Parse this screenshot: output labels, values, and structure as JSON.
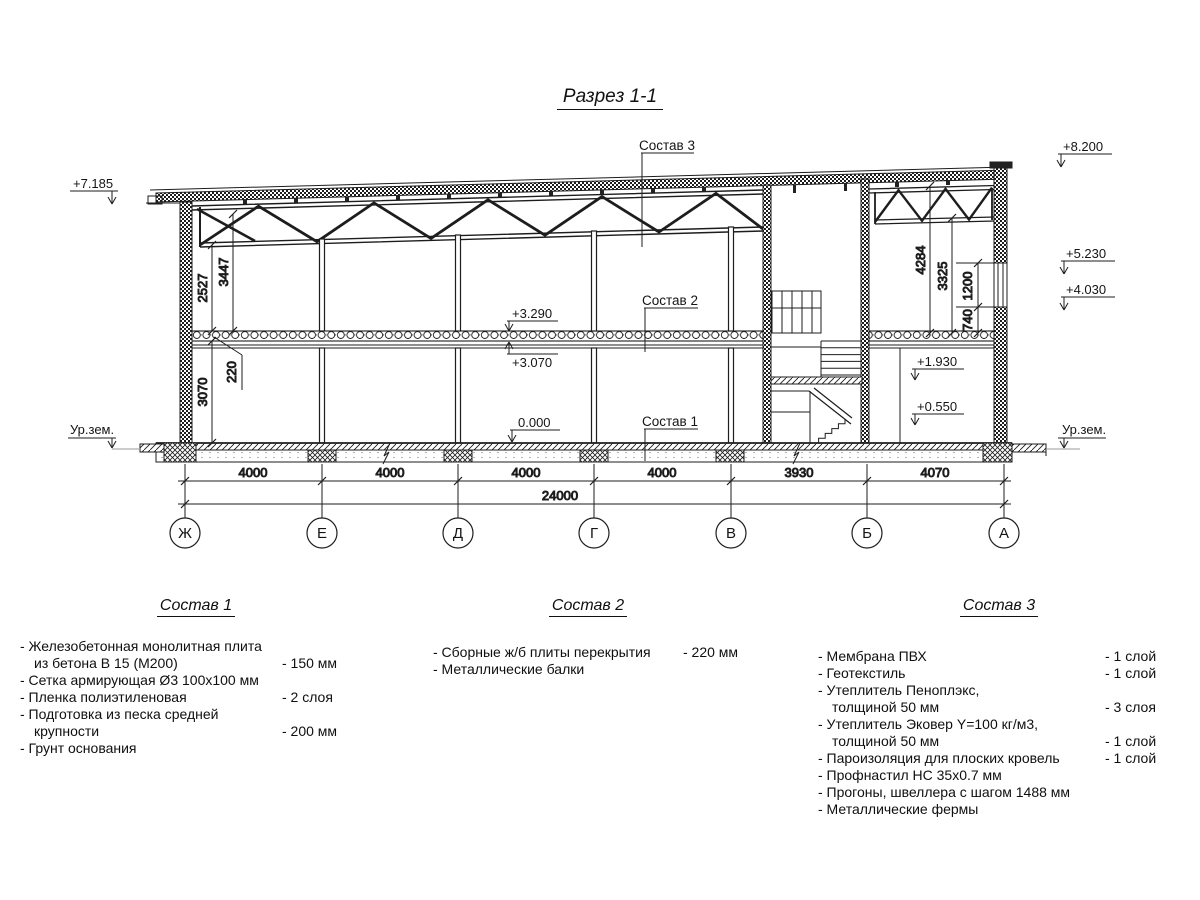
{
  "title": "Разрез 1-1",
  "colors": {
    "line": "#1d1d1d",
    "background": "#ffffff"
  },
  "drawing": {
    "marks": {
      "left_eave": "+7.185",
      "right_parapet": "+8.200",
      "right_window_top": "+5.230",
      "right_window_sill": "+4.030",
      "slab_top": "+3.290",
      "slab_bottom": "+3.070",
      "floor_zero": "0.000",
      "landing": "+1.930",
      "platform": "+0.550"
    },
    "ground_labels": {
      "left": "Ур.зем.",
      "right": "Ур.зем."
    },
    "callouts": {
      "c1": "Состав 1",
      "c2": "Состав 2",
      "c3": "Состав 3"
    },
    "dims_left": [
      "2527",
      "3447",
      "220",
      "3070"
    ],
    "dims_right": [
      "4284",
      "3325",
      "1200",
      "740"
    ],
    "dims_bottom": [
      "4000",
      "4000",
      "4000",
      "4000",
      "3930",
      "4070"
    ],
    "dim_total": "24000",
    "axes": [
      "Ж",
      "Е",
      "Д",
      "Г",
      "В",
      "Б",
      "А"
    ]
  },
  "legend": {
    "sections": [
      {
        "title": "Состав 1",
        "items": [
          {
            "text": "- Железобетонная  монолитная плита",
            "value": ""
          },
          {
            "text": "из бетона В 15 (М200)",
            "value": "- 150 мм"
          },
          {
            "text": "- Сетка армирующая Ø3 100x100 мм",
            "value": ""
          },
          {
            "text": "- Пленка полиэтиленовая",
            "value": "- 2 слоя"
          },
          {
            "text": "- Подготовка из песка средней",
            "value": ""
          },
          {
            "text": "крупности",
            "value": "- 200 мм"
          },
          {
            "text": "- Грунт основания",
            "value": ""
          }
        ]
      },
      {
        "title": "Состав 2",
        "items": [
          {
            "text": "- Сборные ж/б плиты перекрытия",
            "value": "- 220 мм"
          },
          {
            "text": "- Металлические балки",
            "value": ""
          }
        ]
      },
      {
        "title": "Состав 3",
        "items": [
          {
            "text": "- Мембрана ПВХ",
            "value": "- 1 слой"
          },
          {
            "text": "- Геотекстиль",
            "value": "- 1 слой"
          },
          {
            "text": "- Утеплитель Пеноплэкс,",
            "value": ""
          },
          {
            "text": "толщиной 50 мм",
            "value": "- 3 слоя"
          },
          {
            "text": "- Утеплитель Эковер Y=100 кг/м3,",
            "value": ""
          },
          {
            "text": "толщиной 50 мм",
            "value": "- 1 слой"
          },
          {
            "text": "- Пароизоляция для плоских кровель",
            "value": "- 1 слой"
          },
          {
            "text": "- Профнастил НС 35x0.7 мм",
            "value": ""
          },
          {
            "text": "- Прогоны, швеллера с шагом 1488 мм",
            "value": ""
          },
          {
            "text": "- Металлические фермы",
            "value": ""
          }
        ]
      }
    ]
  }
}
